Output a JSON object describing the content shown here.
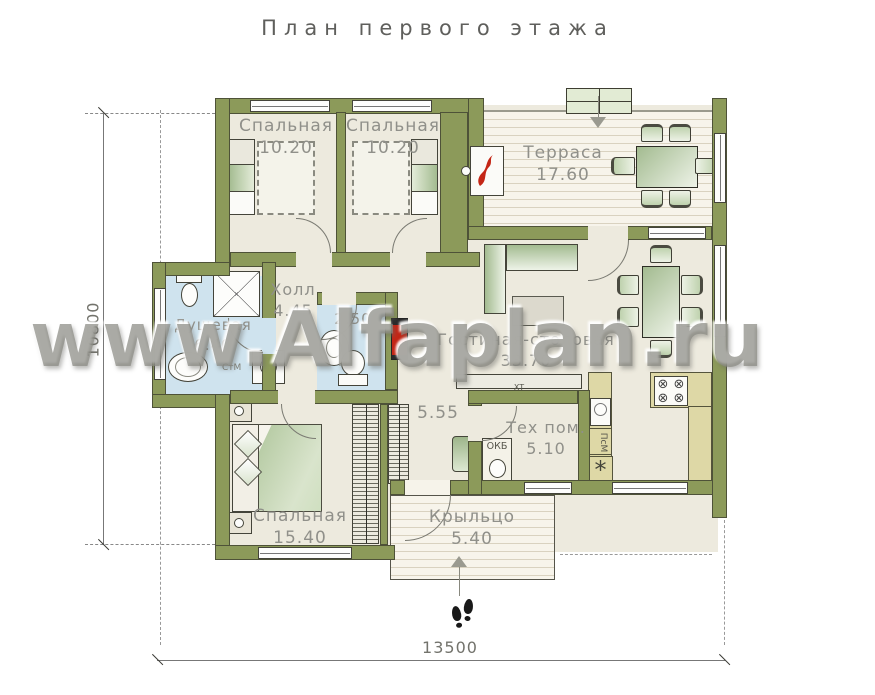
{
  "title": "План первого этажа",
  "watermark": "www.Alfaplan.ru",
  "dimensions": {
    "height_mm": "10800",
    "width_mm": "13500"
  },
  "rooms": {
    "bedroom1": {
      "name": "Спальная",
      "area": "10.20"
    },
    "bedroom2": {
      "name": "Спальная",
      "area": "10.20"
    },
    "terrace": {
      "name": "Терраса",
      "area": "17.60"
    },
    "hall": {
      "name": "Холл",
      "area": "4.45"
    },
    "shower": {
      "name": "Душевая",
      "area": "6.40"
    },
    "wc": {
      "area": "2.50"
    },
    "living": {
      "name": "Гостиная-столовая",
      "area": "33.70"
    },
    "corridor": {
      "area": "5.55"
    },
    "tech": {
      "name": "Тех пом.",
      "area": "5.10"
    },
    "bedroom3": {
      "name": "Спальная",
      "area": "15.40"
    },
    "porch": {
      "name": "Крыльцо",
      "area": "5.40"
    }
  },
  "labels": {
    "boiler": "ОКБ",
    "dishwasher": "ПсМ",
    "washer": "СтМ",
    "tv": "ХТ",
    "fridge_symbol": "*"
  },
  "colors": {
    "wall": "#8c9a5a",
    "floor": "#edeade",
    "bath_floor": "#cfe3ee",
    "counter": "#ded8a6",
    "furniture_green": "#b7cba6",
    "accent_red": "#c42616"
  }
}
